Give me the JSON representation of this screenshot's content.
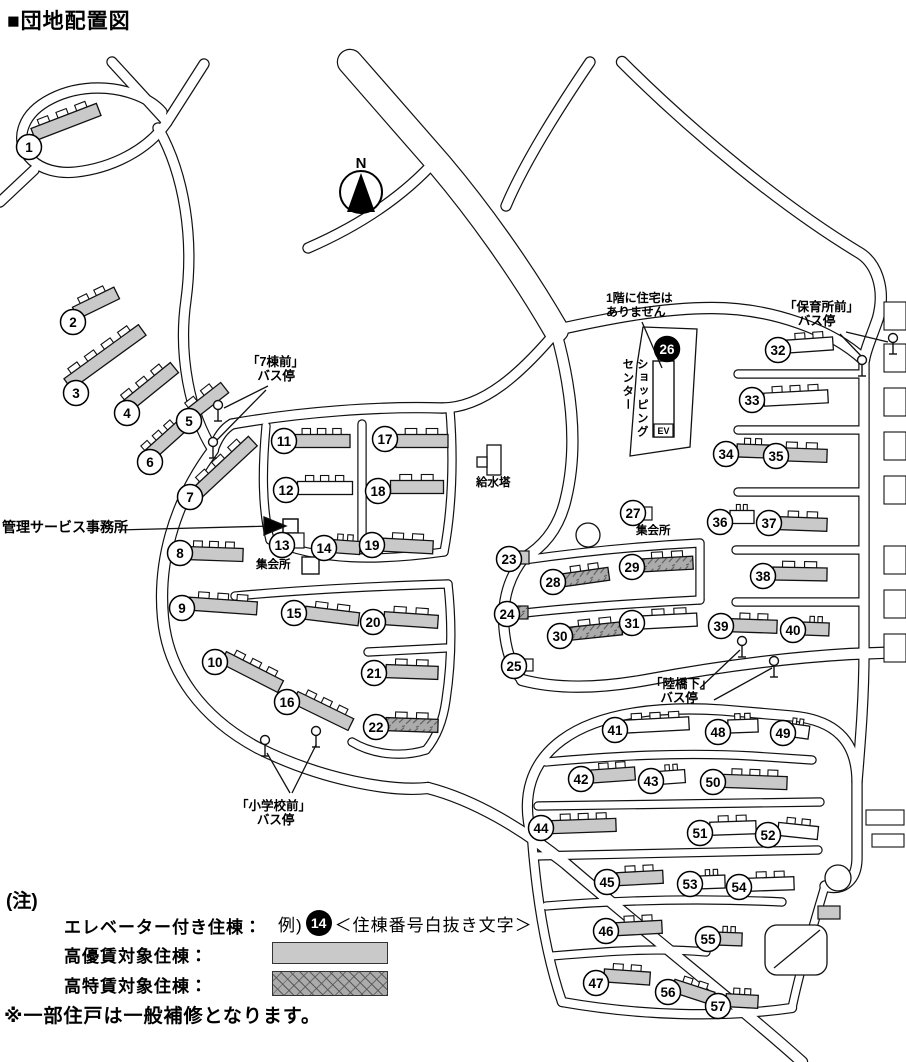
{
  "title": "■団地配置図",
  "compass": {
    "label": "N"
  },
  "colors": {
    "building_gray": "#c9c9c9",
    "hatch_base": "#ababab",
    "outline": "#111111"
  },
  "map": {
    "facilities": {
      "elevator_label": "EV"
    },
    "labels": [
      {
        "name": "management-office-label",
        "x": 2,
        "y": 519,
        "size": 14,
        "text": "管理サービス事務所"
      },
      {
        "name": "bus-stop-7-label",
        "x": 247,
        "y": 355,
        "size": 12.5,
        "text": "「7棟前」\n   バス停"
      },
      {
        "name": "bus-stop-hoikusho-label",
        "x": 784,
        "y": 300,
        "size": 12.5,
        "text": "「保育所前」\n    バス停"
      },
      {
        "name": "bus-stop-rikkyoshita-label",
        "x": 650,
        "y": 677,
        "size": 12.5,
        "text": "「陸橋下」\n   バス停"
      },
      {
        "name": "bus-stop-shogakko-label",
        "x": 236,
        "y": 799,
        "size": 12.5,
        "text": "「小学校前」\n      バス停"
      },
      {
        "name": "meeting-hall-left-label",
        "x": 256,
        "y": 559,
        "size": 11.5,
        "text": "集会所"
      },
      {
        "name": "meeting-hall-right-label",
        "x": 636,
        "y": 525,
        "size": 11.5,
        "text": "集会所"
      },
      {
        "name": "water-tower-label",
        "x": 476,
        "y": 477,
        "size": 11.5,
        "text": "給水塔"
      },
      {
        "name": "no-first-floor-housing-note",
        "x": 606,
        "y": 292,
        "size": 12,
        "text": "1階に住宅は\nありません"
      },
      {
        "name": "shopping-center-label",
        "x": 620,
        "y": 358,
        "size": 11.5,
        "text": "ショッピング\nセンター",
        "vertical": true
      }
    ],
    "bus_poles": [
      {
        "x": 218,
        "y": 405
      },
      {
        "x": 213,
        "y": 442
      },
      {
        "x": 862,
        "y": 360
      },
      {
        "x": 893,
        "y": 338
      },
      {
        "x": 742,
        "y": 641
      },
      {
        "x": 774,
        "y": 661
      },
      {
        "x": 265,
        "y": 740
      },
      {
        "x": 316,
        "y": 731
      }
    ],
    "buildings": [
      {
        "n": 1,
        "x": 29,
        "y": 147,
        "fill": "gray",
        "bar": {
          "cx": 66,
          "cy": 122,
          "len": 70,
          "ang": -21
        }
      },
      {
        "n": 2,
        "x": 73,
        "y": 322,
        "fill": "gray",
        "bar": {
          "cx": 96,
          "cy": 303,
          "len": 46,
          "ang": -26
        }
      },
      {
        "n": 3,
        "x": 76,
        "y": 393,
        "fill": "gray",
        "bar": {
          "cx": 105,
          "cy": 357,
          "len": 92,
          "ang": -36
        }
      },
      {
        "n": 4,
        "x": 127,
        "y": 413,
        "fill": "gray",
        "bar": {
          "cx": 148,
          "cy": 389,
          "len": 68,
          "ang": -39
        }
      },
      {
        "n": 5,
        "x": 189,
        "y": 421,
        "fill": "gray",
        "bar": {
          "cx": 205,
          "cy": 403,
          "len": 50,
          "ang": -38
        }
      },
      {
        "n": 6,
        "x": 150,
        "y": 462,
        "fill": "gray",
        "bar": {
          "cx": 164,
          "cy": 442,
          "len": 56,
          "ang": -42
        }
      },
      {
        "n": 7,
        "x": 190,
        "y": 497,
        "fill": "gray",
        "bar": {
          "cx": 225,
          "cy": 467,
          "len": 76,
          "ang": -43
        }
      },
      {
        "n": 8,
        "x": 180,
        "y": 553,
        "fill": "gray",
        "bar": {
          "cx": 214,
          "cy": 554,
          "len": 58,
          "ang": 2
        }
      },
      {
        "n": 9,
        "x": 182,
        "y": 608,
        "fill": "gray",
        "bar": {
          "cx": 223,
          "cy": 606,
          "len": 68,
          "ang": 4
        }
      },
      {
        "n": 10,
        "x": 215,
        "y": 662,
        "fill": "gray",
        "bar": {
          "cx": 252,
          "cy": 672,
          "len": 64,
          "ang": 27
        }
      },
      {
        "n": 11,
        "x": 284,
        "y": 441,
        "fill": "gray",
        "bar": {
          "cx": 322,
          "cy": 441,
          "len": 56,
          "ang": 0
        }
      },
      {
        "n": 12,
        "x": 286,
        "y": 490,
        "fill": "white",
        "bar": {
          "cx": 325,
          "cy": 488,
          "len": 55,
          "ang": 0
        }
      },
      {
        "n": 13,
        "x": 282,
        "y": 545,
        "fill": "white",
        "sq": {
          "x": 288,
          "y": 533,
          "w": 16,
          "h": 15
        }
      },
      {
        "n": 14,
        "x": 324,
        "y": 548,
        "fill": "gray",
        "bar": {
          "cx": 345,
          "cy": 547,
          "len": 30,
          "ang": 4
        }
      },
      {
        "n": 15,
        "x": 294,
        "y": 613,
        "fill": "gray",
        "bar": {
          "cx": 332,
          "cy": 616,
          "len": 54,
          "ang": 7
        }
      },
      {
        "n": 16,
        "x": 287,
        "y": 702,
        "fill": "gray",
        "bar": {
          "cx": 323,
          "cy": 711,
          "len": 62,
          "ang": 26
        }
      },
      {
        "n": 17,
        "x": 385,
        "y": 439,
        "fill": "gray",
        "bar": {
          "cx": 422,
          "cy": 441,
          "len": 52,
          "ang": 0
        }
      },
      {
        "n": 18,
        "x": 378,
        "y": 491,
        "fill": "gray",
        "bar": {
          "cx": 417,
          "cy": 487,
          "len": 53,
          "ang": 0
        }
      },
      {
        "n": 19,
        "x": 372,
        "y": 545,
        "fill": "gray",
        "bar": {
          "cx": 408,
          "cy": 546,
          "len": 50,
          "ang": 3
        }
      },
      {
        "n": 20,
        "x": 373,
        "y": 622,
        "fill": "gray",
        "bar": {
          "cx": 411,
          "cy": 620,
          "len": 54,
          "ang": 4
        }
      },
      {
        "n": 21,
        "x": 374,
        "y": 673,
        "fill": "gray",
        "bar": {
          "cx": 412,
          "cy": 672,
          "len": 52,
          "ang": 2
        }
      },
      {
        "n": 22,
        "x": 376,
        "y": 727,
        "fill": "hatch",
        "bar": {
          "cx": 412,
          "cy": 725,
          "len": 52,
          "ang": 2
        }
      },
      {
        "n": 23,
        "x": 509,
        "y": 559,
        "fill": "gray",
        "sq": {
          "x": 519,
          "y": 551,
          "w": 10,
          "h": 13
        }
      },
      {
        "n": 24,
        "x": 507,
        "y": 614,
        "fill": "hatch",
        "sq": {
          "x": 518,
          "y": 606,
          "w": 10,
          "h": 13
        }
      },
      {
        "n": 25,
        "x": 514,
        "y": 666,
        "fill": "white",
        "sq": {
          "x": 523,
          "y": 659,
          "w": 10,
          "h": 12
        }
      },
      {
        "n": 26,
        "x": 667,
        "y": 349,
        "fill": "none",
        "badge": "black"
      },
      {
        "n": 27,
        "x": 633,
        "y": 513,
        "fill": "white",
        "sq": {
          "x": 643,
          "y": 507,
          "w": 9,
          "h": 13
        }
      },
      {
        "n": 28,
        "x": 553,
        "y": 582,
        "fill": "hatch",
        "bar": {
          "cx": 586,
          "cy": 577,
          "len": 46,
          "ang": -8
        }
      },
      {
        "n": 29,
        "x": 632,
        "y": 567,
        "fill": "hatch",
        "bar": {
          "cx": 668,
          "cy": 564,
          "len": 50,
          "ang": -3
        }
      },
      {
        "n": 30,
        "x": 560,
        "y": 636,
        "fill": "hatch",
        "bar": {
          "cx": 596,
          "cy": 631,
          "len": 52,
          "ang": -6
        }
      },
      {
        "n": 31,
        "x": 632,
        "y": 623,
        "fill": "white",
        "bar": {
          "cx": 670,
          "cy": 621,
          "len": 54,
          "ang": -3
        }
      },
      {
        "n": 32,
        "x": 778,
        "y": 350,
        "fill": "white",
        "bar": {
          "cx": 810,
          "cy": 345,
          "len": 46,
          "ang": -4
        }
      },
      {
        "n": 33,
        "x": 752,
        "y": 400,
        "fill": "white",
        "bar": {
          "cx": 796,
          "cy": 398,
          "len": 64,
          "ang": -3
        }
      },
      {
        "n": 34,
        "x": 726,
        "y": 454,
        "fill": "gray",
        "bar": {
          "cx": 753,
          "cy": 451,
          "len": 32,
          "ang": 2
        }
      },
      {
        "n": 35,
        "x": 776,
        "y": 456,
        "fill": "gray",
        "bar": {
          "cx": 802,
          "cy": 455,
          "len": 50,
          "ang": 2
        }
      },
      {
        "n": 36,
        "x": 720,
        "y": 522,
        "fill": "white",
        "bar": {
          "cx": 742,
          "cy": 517,
          "len": 24,
          "ang": 0
        }
      },
      {
        "n": 37,
        "x": 769,
        "y": 523,
        "fill": "gray",
        "bar": {
          "cx": 803,
          "cy": 524,
          "len": 48,
          "ang": 2
        }
      },
      {
        "n": 38,
        "x": 763,
        "y": 576,
        "fill": "gray",
        "bar": {
          "cx": 800,
          "cy": 574,
          "len": 54,
          "ang": 1
        }
      },
      {
        "n": 39,
        "x": 721,
        "y": 626,
        "fill": "gray",
        "bar": {
          "cx": 754,
          "cy": 626,
          "len": 46,
          "ang": 2
        }
      },
      {
        "n": 40,
        "x": 793,
        "y": 630,
        "fill": "gray",
        "bar": {
          "cx": 816,
          "cy": 629,
          "len": 26,
          "ang": 2
        }
      },
      {
        "n": 41,
        "x": 615,
        "y": 730,
        "fill": "white",
        "bar": {
          "cx": 656,
          "cy": 725,
          "len": 66,
          "ang": -3
        }
      },
      {
        "n": 42,
        "x": 581,
        "y": 779,
        "fill": "gray",
        "bar": {
          "cx": 613,
          "cy": 775,
          "len": 44,
          "ang": -4
        }
      },
      {
        "n": 43,
        "x": 651,
        "y": 781,
        "fill": "white",
        "bar": {
          "cx": 672,
          "cy": 777,
          "len": 26,
          "ang": -4
        }
      },
      {
        "n": 44,
        "x": 541,
        "y": 828,
        "fill": "gray",
        "bar": {
          "cx": 584,
          "cy": 826,
          "len": 64,
          "ang": -2
        }
      },
      {
        "n": 45,
        "x": 607,
        "y": 882,
        "fill": "gray",
        "bar": {
          "cx": 640,
          "cy": 878,
          "len": 46,
          "ang": -3
        }
      },
      {
        "n": 46,
        "x": 606,
        "y": 931,
        "fill": "gray",
        "bar": {
          "cx": 639,
          "cy": 928,
          "len": 46,
          "ang": -3
        }
      },
      {
        "n": 47,
        "x": 596,
        "y": 983,
        "fill": "gray",
        "bar": {
          "cx": 627,
          "cy": 977,
          "len": 46,
          "ang": 4
        }
      },
      {
        "n": 48,
        "x": 718,
        "y": 732,
        "fill": "white",
        "bar": {
          "cx": 743,
          "cy": 726,
          "len": 30,
          "ang": -2
        }
      },
      {
        "n": 49,
        "x": 783,
        "y": 733,
        "fill": "white",
        "bar": {
          "cx": 797,
          "cy": 731,
          "len": 24,
          "ang": 8
        }
      },
      {
        "n": 50,
        "x": 713,
        "y": 782,
        "fill": "gray",
        "bar": {
          "cx": 755,
          "cy": 782,
          "len": 64,
          "ang": 2
        }
      },
      {
        "n": 51,
        "x": 700,
        "y": 833,
        "fill": "white",
        "bar": {
          "cx": 733,
          "cy": 828,
          "len": 46,
          "ang": -2
        }
      },
      {
        "n": 52,
        "x": 768,
        "y": 835,
        "fill": "white",
        "bar": {
          "cx": 798,
          "cy": 831,
          "len": 40,
          "ang": 6
        }
      },
      {
        "n": 53,
        "x": 690,
        "y": 884,
        "fill": "white",
        "bar": {
          "cx": 712,
          "cy": 882,
          "len": 26,
          "ang": -2
        }
      },
      {
        "n": 54,
        "x": 739,
        "y": 887,
        "fill": "white",
        "bar": {
          "cx": 771,
          "cy": 884,
          "len": 46,
          "ang": -2
        }
      },
      {
        "n": 55,
        "x": 708,
        "y": 939,
        "fill": "gray",
        "bar": {
          "cx": 729,
          "cy": 939,
          "len": 26,
          "ang": 2
        }
      },
      {
        "n": 56,
        "x": 668,
        "y": 992,
        "fill": "gray",
        "bar": {
          "cx": 693,
          "cy": 992,
          "len": 42,
          "ang": 18
        }
      },
      {
        "n": 57,
        "x": 718,
        "y": 1006,
        "fill": "gray",
        "bar": {
          "cx": 742,
          "cy": 1001,
          "len": 32,
          "ang": 3
        }
      }
    ]
  },
  "legend": {
    "heading": "(注)",
    "elevator_label": "エレベーター付き住棟：",
    "example_prefix": "例)",
    "example_number": "14",
    "example_suffix": "＜住棟番号白抜き文字＞",
    "koyuchin_label": "高優賃対象住棟：",
    "kotokuchin_label": "高特賃対象住棟：",
    "repair_note": "※一部住戸は一般補修となります。"
  }
}
